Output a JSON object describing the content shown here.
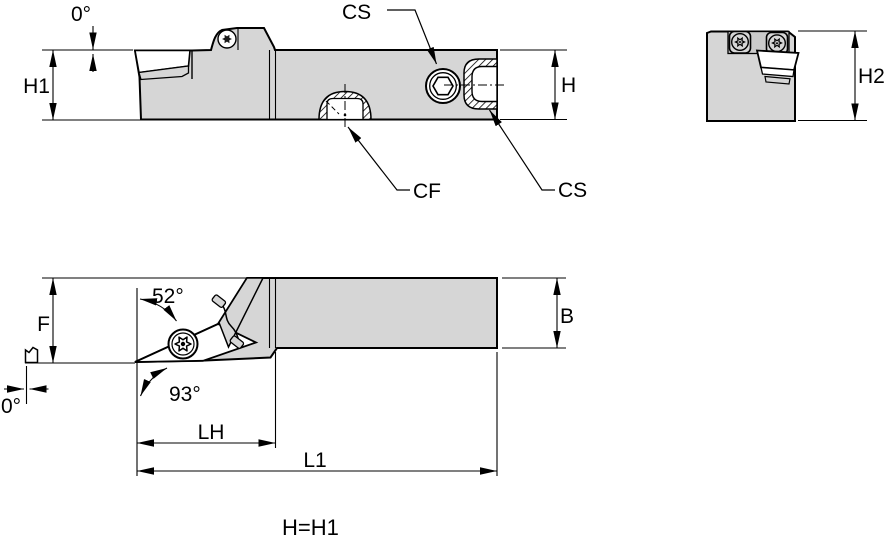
{
  "drawing": {
    "type": "toolholder-dimension-drawing",
    "note": "H=H1",
    "colors": {
      "body_fill": "#d6d6d6",
      "outline": "#000000",
      "background": "#ffffff"
    }
  },
  "labels": {
    "top_rake_angle": "0°",
    "h1": "H1",
    "cs_clamp_screw": "CS",
    "h": "H",
    "h2": "H2",
    "cf_coolant": "CF",
    "cs_end": "CS",
    "f": "F",
    "insert_top_angle": "52°",
    "lead_angle": "93°",
    "b": "B",
    "bottom_offset_angle": "0°",
    "lh": "LH",
    "l1": "L1",
    "note": "H=H1"
  }
}
